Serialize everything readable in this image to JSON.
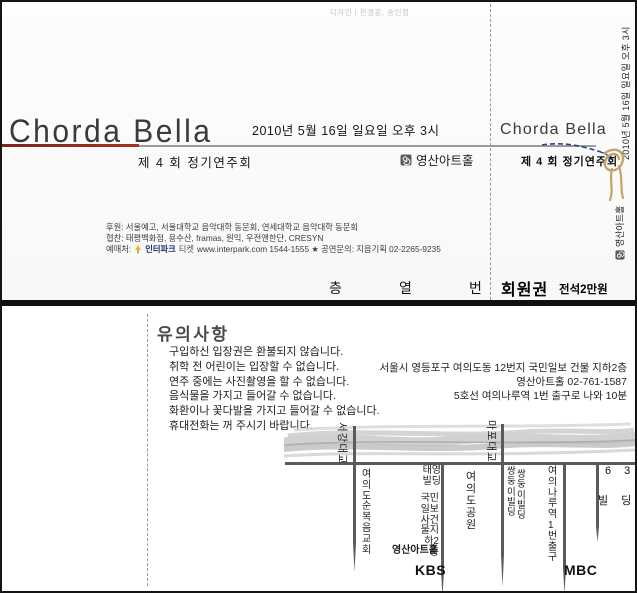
{
  "meta": {
    "design_credit": "디자인 | 한경훈, 송인정"
  },
  "front": {
    "title": "Chorda Bella",
    "edition": "제 4 회 정기연주회",
    "datetime": "2010년 5월 16일 일요일 오후 3시",
    "venue": "영산아트홀",
    "sponsor1": "후원: 서울예고, 서울대학교 음악대학 동문회, 연세대학교 음악대학 동문회",
    "sponsor2": "협찬: 태평백화점, 용수산, framas, 원익, 우전앤한단, CRESYN",
    "booking_prefix": "예매처:",
    "interpark": "인터파크",
    "interpark_ticket": "티켓",
    "booking_rest": "www.interpark.com 1544-1555 ★ 공연문의: 지음기획 02-2265-9235",
    "seat": {
      "floor": "층",
      "row": "열",
      "number": "번"
    }
  },
  "stub": {
    "title": "Chorda Bella",
    "edition": "제 4 회 정기연주회",
    "datetime": "2010년 5월 16일 일요일 오후 3시",
    "venue": "영산아트홀",
    "ticket_type": "회원권",
    "price": "전석2만원"
  },
  "back": {
    "notice_title": "유의사항",
    "notices": [
      "구입하신 입장권은 환불되지 않습니다.",
      "취학 전 어린이는 입장할 수 없습니다.",
      "연주 중에는 사진촬영을 할 수 없습니다.",
      "음식물을 가지고 들어갈 수 없습니다.",
      "화환이나 꽃다발을 가지고 들어갈 수 없습니다.",
      "휴대전화는 꺼 주시기 바랍니다."
    ],
    "address": [
      "서울시 영등포구 여의도동 12번지 국민일보 건물 지하2층",
      "영산아트홀 02-761-1587",
      "5호선 여의나루역 1번 출구로 나와 10분"
    ],
    "map": {
      "bridge_left": "서강대교",
      "bridge_right": "마포대교",
      "church": "여의도순복음교회",
      "taeyoung_bldg": "태영빌딩",
      "kukmin_bldg": "국민일보사건물지하2층",
      "venue_hall": "영산아트홀",
      "park": "여의도공원",
      "twin_bldg": "쌍둥이빌딩",
      "station_exit": "여의나루역1번출구",
      "b63_top": "6 3",
      "b63_bottom": "빌 딩",
      "kbs": "KBS",
      "mbc": "MBC"
    }
  },
  "colors": {
    "accent_red": "#8e2b1f",
    "thread_blue": "#2b3f93",
    "rope_tan": "#c2a36b",
    "road_gray": "#5a5a5a",
    "brush_gray": "#c0c0c0"
  }
}
